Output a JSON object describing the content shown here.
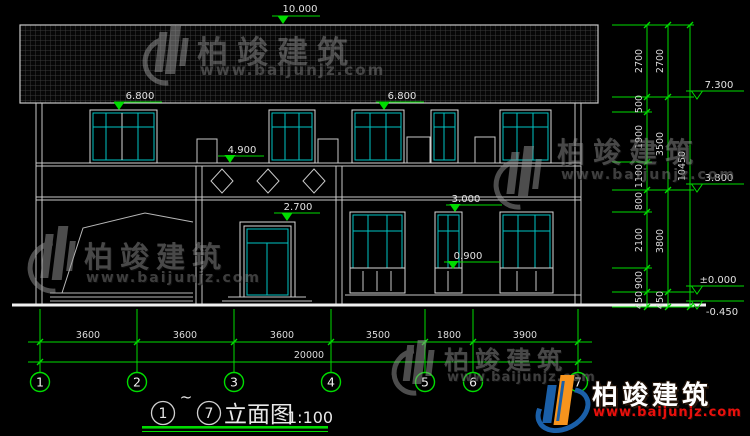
{
  "drawing": {
    "background": "#000000",
    "colors": {
      "dimension_green": "#00DC00",
      "line_white": "#C8C8C8",
      "glazing_cyan": "#00C3C3",
      "watermark_gray": "#8F8F8F",
      "logo_blue": "#1A5FA8",
      "logo_orange": "#F7941D",
      "logo_red": "#E8100C"
    },
    "watermark": {
      "brand": "柏竣建筑",
      "url": "www.baijunjz.com"
    },
    "logo": {
      "brand": "柏竣建筑",
      "url": "www.baijunjz.com"
    },
    "title": {
      "from_axis": "1",
      "tilde": "~",
      "to_axis": "7",
      "name": "立面图",
      "scale": "1:100"
    },
    "levels": {
      "facade": [
        "10.000",
        "6.800",
        "6.800",
        "4.900",
        "3.000",
        "2.700",
        "0.900"
      ],
      "right": [
        "7.300",
        "3.800",
        "±0.000",
        "-0.450"
      ]
    },
    "dimensions": {
      "bottom_segments": [
        "3600",
        "3600",
        "3600",
        "3500",
        "1800",
        "3900"
      ],
      "bottom_total": "20000",
      "right_inner": [
        "2700",
        "500",
        "1900",
        "1100",
        "800",
        "2100",
        "900",
        "450"
      ],
      "right_middle": [
        "2700",
        "3500",
        "3800",
        "450"
      ],
      "right_total": "10450"
    },
    "axes": [
      "1",
      "2",
      "3",
      "4",
      "5",
      "6",
      "7"
    ]
  }
}
